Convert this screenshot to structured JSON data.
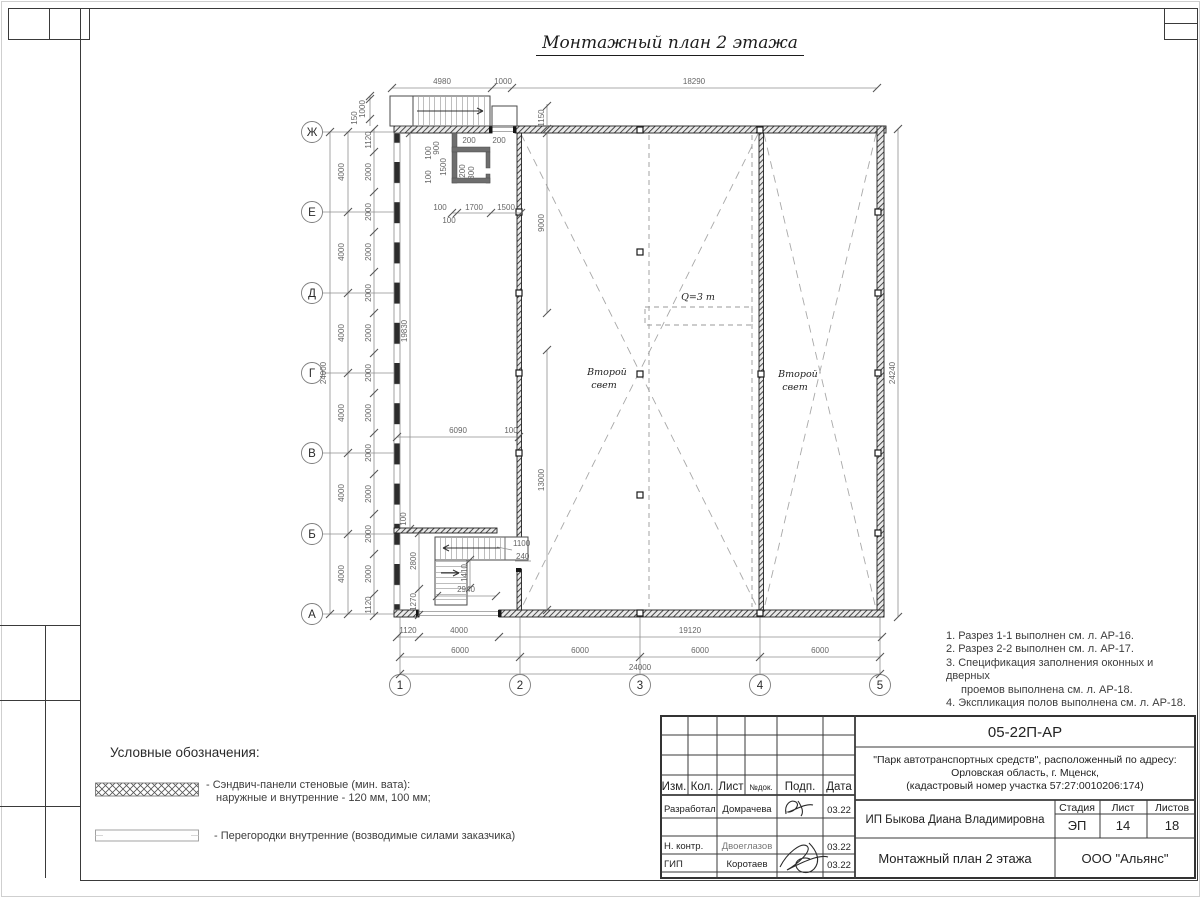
{
  "sheet_title": "Монтажный план 2 этажа",
  "plan": {
    "axes": {
      "letters": [
        "Ж",
        "Е",
        "Д",
        "Г",
        "В",
        "Б",
        "А"
      ],
      "numbers": [
        "1",
        "2",
        "3",
        "4",
        "5"
      ]
    },
    "labels": {
      "second_light_line1": "Второй",
      "second_light_line2": "свет",
      "crane": "Q=3 т"
    },
    "dims": {
      "d4980": "4980",
      "d1000": "1000",
      "d18290": "18290",
      "d1150": "1150",
      "d150": "150",
      "d1120": "1120",
      "d2000": "2000",
      "d4000": "4000",
      "d24000": "24000",
      "d24240": "24240",
      "d19830": "19830",
      "d9000": "9000",
      "d13000": "13000",
      "d6090": "6090",
      "d100": "100",
      "d900": "900",
      "d200": "200",
      "d300": "300",
      "d1700": "1700",
      "d1500": "1500",
      "d2800": "2800",
      "d1270": "1270",
      "d2940": "2940",
      "d1410": "1410",
      "d1100": "1100",
      "d240": "240",
      "d6000": "6000",
      "d19120": "19120"
    }
  },
  "notes": {
    "lines": [
      "1. Разрез 1-1 выполнен см. л. АР-16.",
      "2. Разрез 2-2 выполнен см. л. АР-17.",
      "3. Спецификация заполнения оконных и дверных",
      "проемов выполнена см. л. АР-18.",
      "4. Экспликация полов выполнена см. л. АР-18."
    ]
  },
  "legend": {
    "title": "Условные обозначения:",
    "item1_line1": "- Сэндвич-панели стеновые (мин. вата):",
    "item1_line2": "наружные и внутренние - 120 мм, 100 мм;",
    "item2": "- Перегородки внутренние (возводимые силами заказчика)"
  },
  "titleblock": {
    "designation": "05-22П-АР",
    "project_line1": "\"Парк автотранспортных средств\",  расположенный по адресу:",
    "project_line2": "Орловская область, г. Мценск,",
    "project_line3": "(кадастровый номер участка 57:27:0010206:174)",
    "client": "ИП Быкова Диана Владимировна",
    "doc_title": "Монтажный план 2 этажа",
    "company": "ООО \"Альянс\"",
    "cols": {
      "izm": "Изм.",
      "kol": "Кол.",
      "list": "Лист",
      "ndoc": "№док.",
      "podp": "Подп.",
      "data": "Дата"
    },
    "stage": {
      "h1": "Стадия",
      "h2": "Лист",
      "h3": "Листов",
      "v1": "ЭП",
      "v2": "14",
      "v3": "18"
    },
    "rows": [
      {
        "role": "Разработал",
        "name": "Домрачева",
        "date": "03.22"
      },
      {
        "role": "Н. контр.",
        "name": "Двоеглазов",
        "date": "03.22"
      },
      {
        "role": "ГИП",
        "name": "Коротаев",
        "date": "03.22"
      }
    ]
  }
}
